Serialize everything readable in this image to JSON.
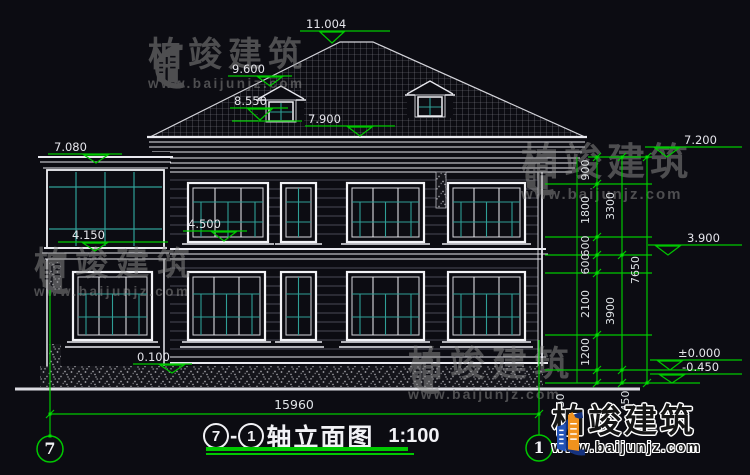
{
  "title": {
    "axis_start": "7",
    "separator": "-",
    "axis_end": "1",
    "name": "轴立面图",
    "scale": "1:100"
  },
  "axis_bubbles": {
    "left": "7",
    "right": "1"
  },
  "levels": {
    "left": [
      "11.004",
      "9.600",
      "8.550",
      "7.900",
      "7.080",
      "4.500",
      "4.150",
      "0.100"
    ],
    "right": [
      "7.200",
      "3.900",
      "±0.000",
      "-0.450"
    ]
  },
  "dimensions": {
    "chain_inner": [
      "900",
      "1800",
      "600",
      "600",
      "2100",
      "1200",
      "450"
    ],
    "chain_middle": [
      "3300",
      "3900",
      "450"
    ],
    "chain_outer": [
      "7650"
    ],
    "bottom_width": "15960"
  },
  "watermark": {
    "name": "柏竣建筑",
    "url": "www.baijunjz.com"
  },
  "brand": {
    "name": "柏竣建筑",
    "url": "www.baijunjz.com"
  },
  "colors": {
    "background": "#0c0c12",
    "line_white": "#e9e9ef",
    "dim_green": "#00c800",
    "glass_teal": "#2f9e96",
    "siding_gray": "#4a4a55",
    "watermark_gray": "#8f8f8f",
    "logo_blue": "#2353b8",
    "logo_orange": "#f0921e",
    "logo_navy": "#16337e"
  }
}
